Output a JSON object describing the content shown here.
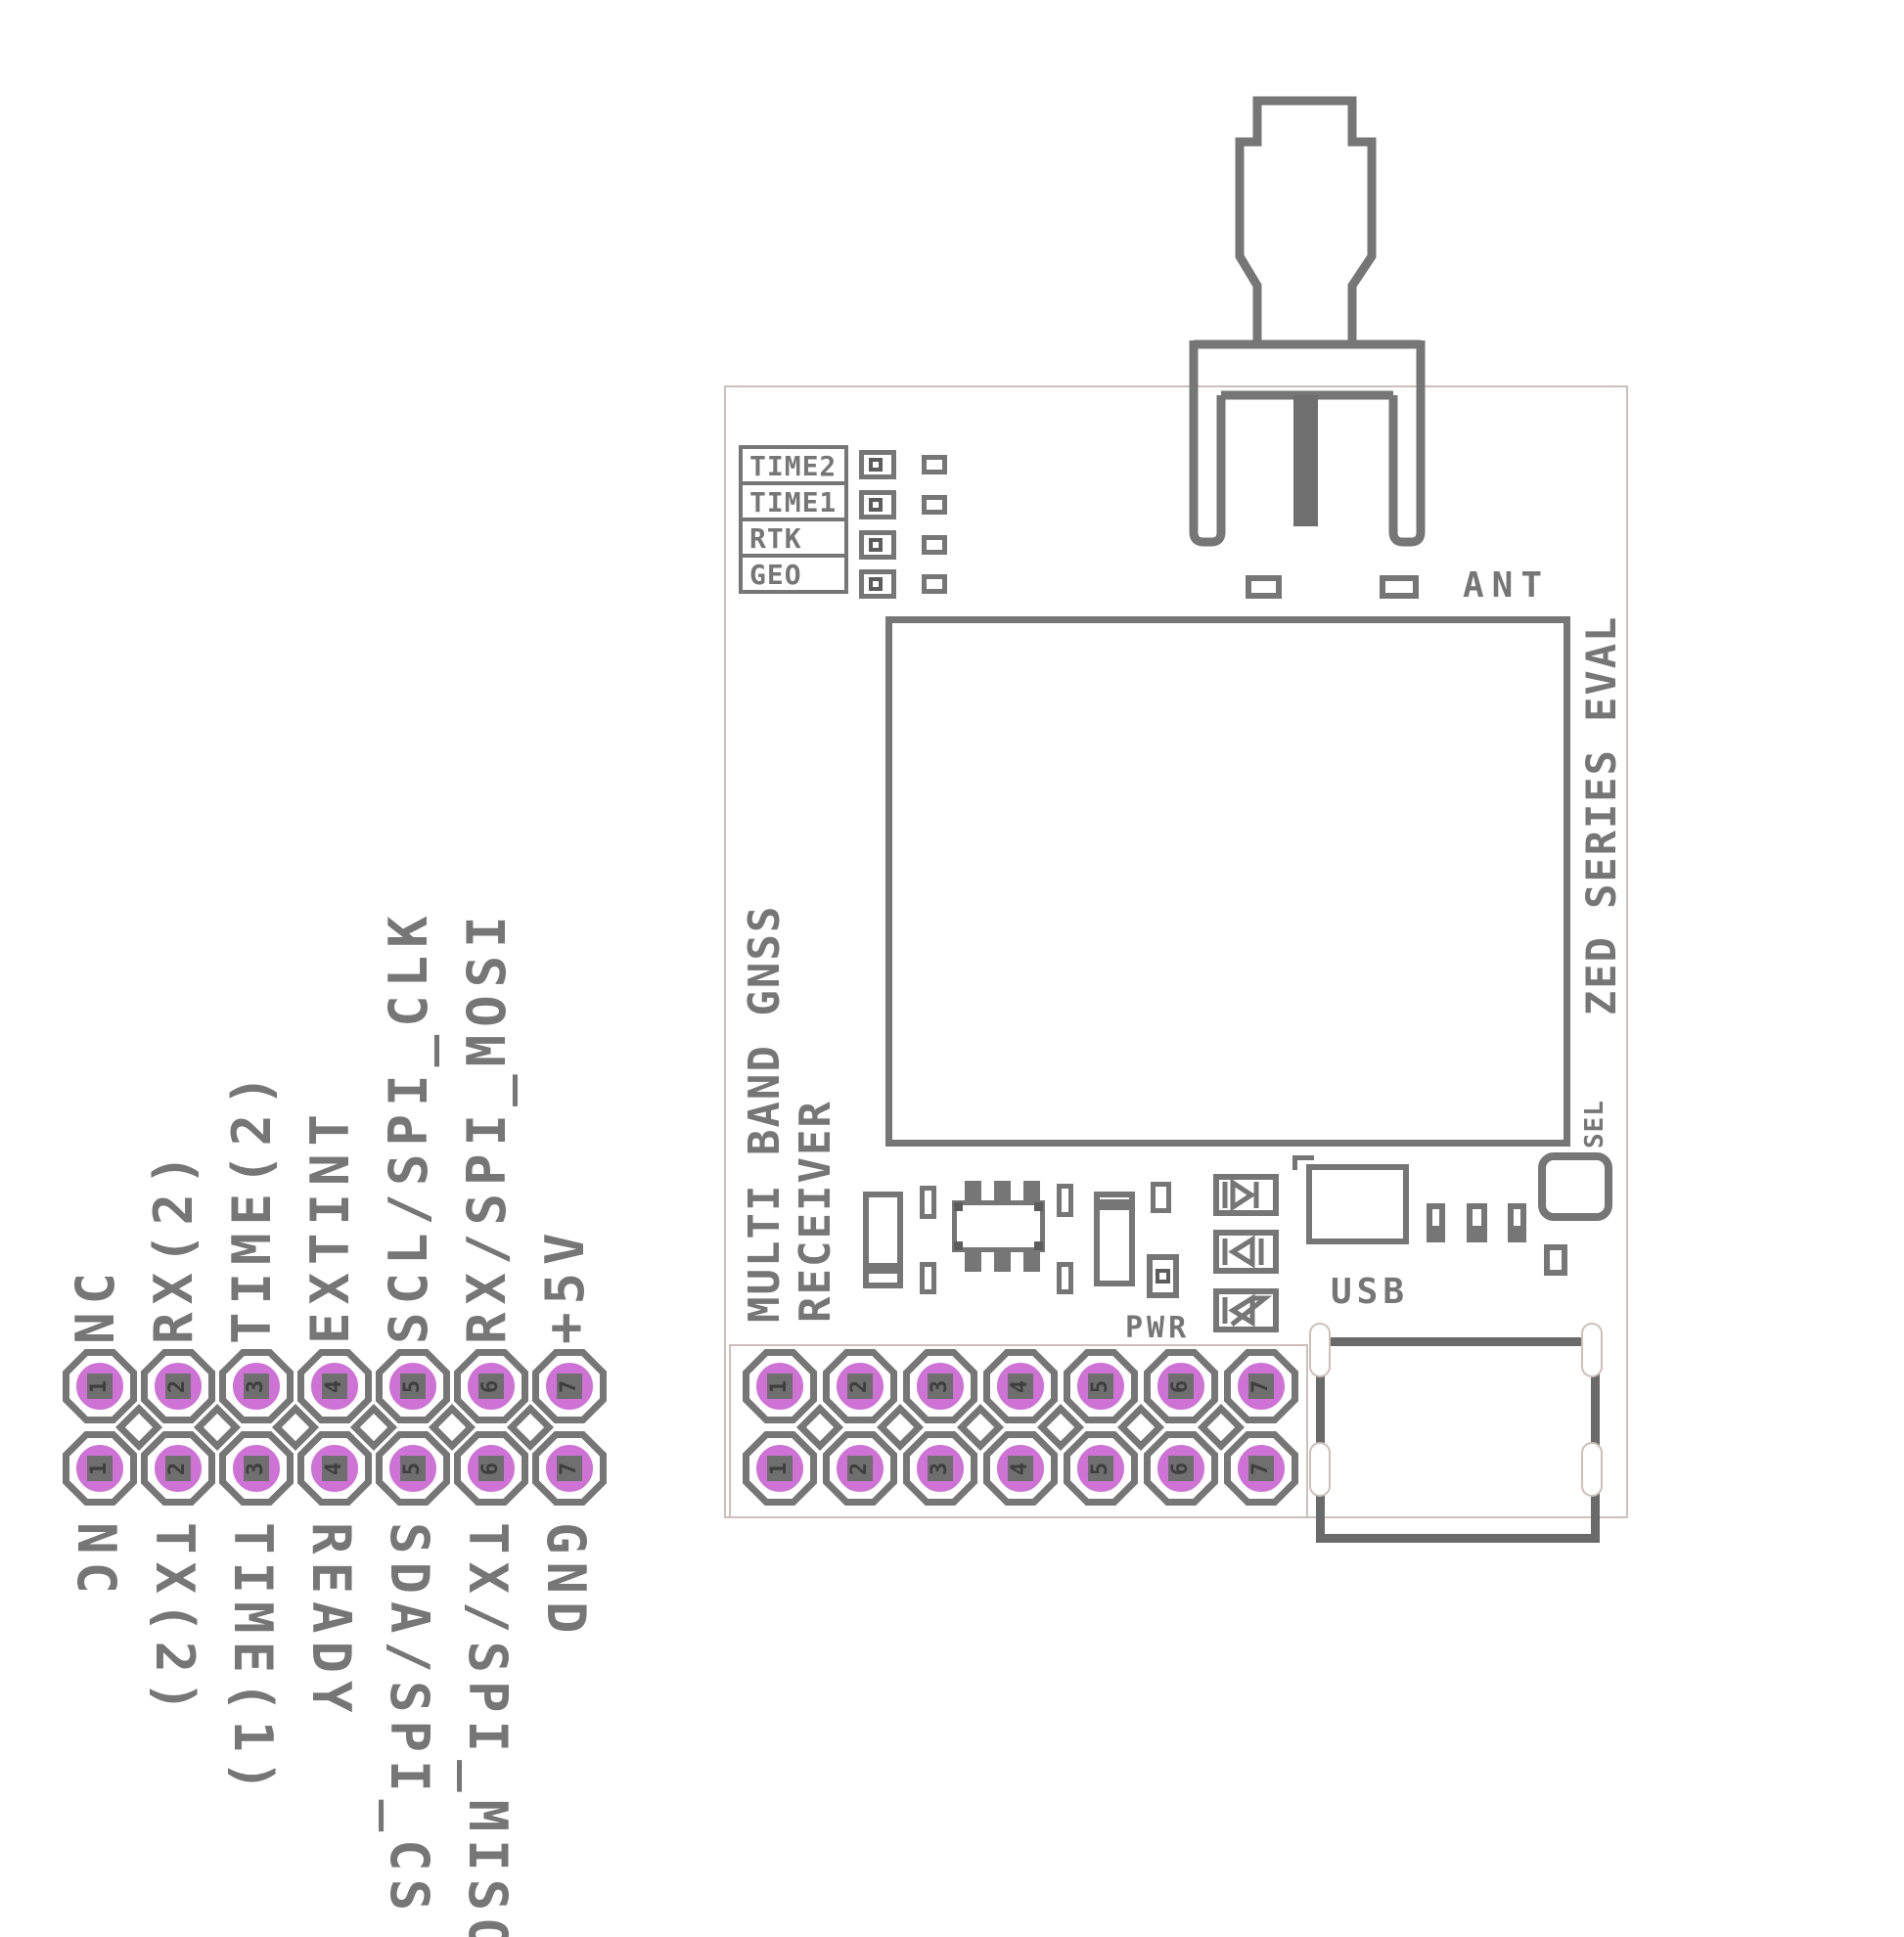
{
  "legend": {
    "top_labels": [
      "NC",
      "RX(2)",
      "TIME(2)",
      "EXTINT",
      "SCL/SPI_CLK",
      "RX/SPI_MOSI",
      "+5V"
    ],
    "bottom_labels": [
      "NC",
      "TX(2)",
      "TIME(1)",
      "READY",
      "SDA/SPI_CS",
      "TX/SPI_MISO",
      "GND"
    ],
    "row1_pins": [
      "1",
      "2",
      "3",
      "4",
      "5",
      "6",
      "7"
    ],
    "row2_pins": [
      "1",
      "2",
      "3",
      "4",
      "5",
      "6",
      "7"
    ]
  },
  "board": {
    "led_labels": [
      "TIME2",
      "TIME1",
      "RTK",
      "GEO"
    ],
    "ant_label": "ANT",
    "silk_text_line1": "MULTI BAND GNSS",
    "silk_text_line2": "RECEIVER",
    "edge_title": "ZED SERIES EVAL",
    "sel_label": "SEL",
    "usb_label": "USB",
    "pwr_label": "PWR",
    "header_row1_pins": [
      "1",
      "2",
      "3",
      "4",
      "5",
      "6",
      "7"
    ],
    "header_row2_pins": [
      "1",
      "2",
      "3",
      "4",
      "5",
      "6",
      "7"
    ]
  },
  "colors": {
    "silk_gray": "#767676",
    "pad_pink": "#ce72d6",
    "thin_outline": "#cdc0ba",
    "pin_square": "#6f6f6f",
    "digit": "#3e3e3e"
  }
}
